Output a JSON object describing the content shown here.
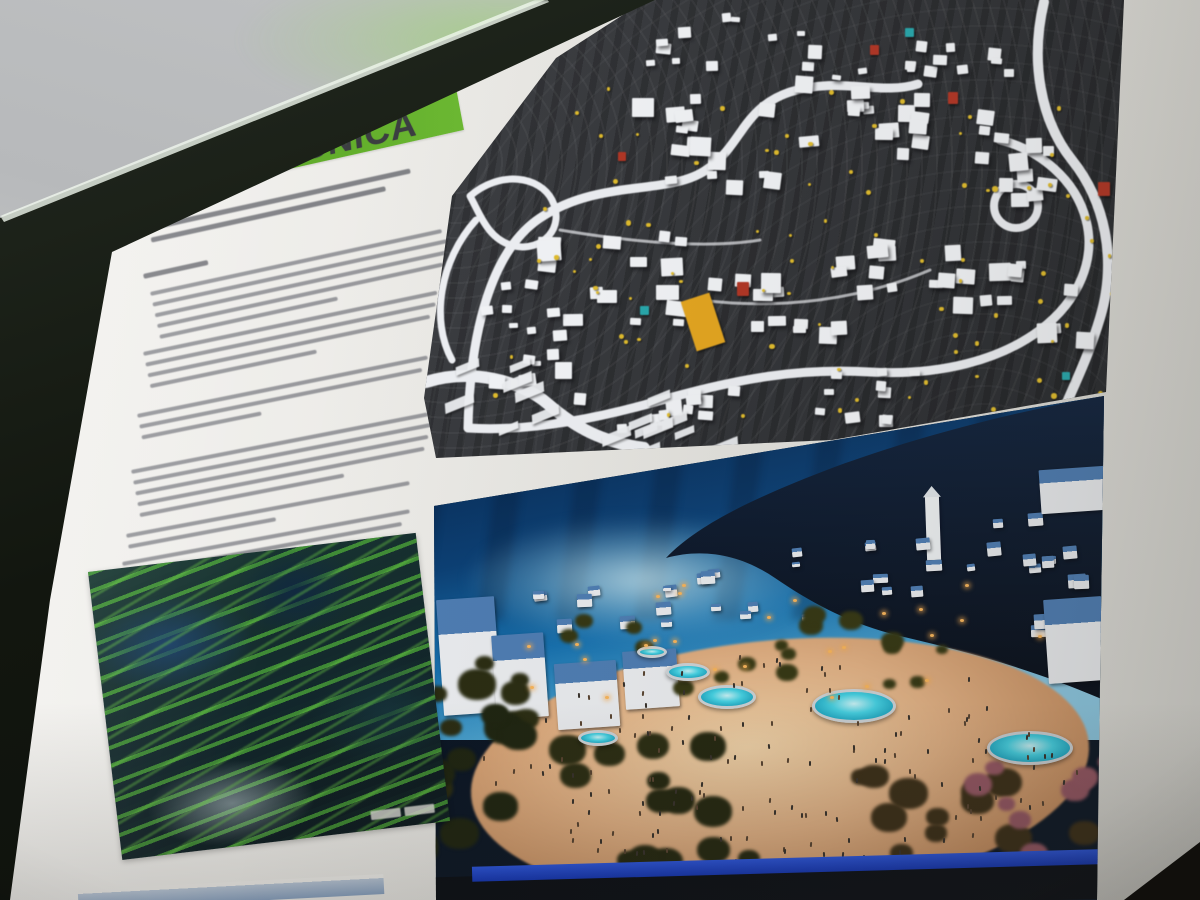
{
  "logo": {
    "kicker": "NOVA",
    "title": "KOREŠNICA",
    "banner_color": "#5fa827",
    "title_color": "#3b3e41"
  },
  "text_column": {
    "quote_lines": [
      268,
      240
    ],
    "attribution_width": 66,
    "paragraphs": [
      [
        298,
        306,
        300,
        292,
        182
      ],
      [
        300,
        296,
        288,
        170
      ],
      [
        296,
        288,
        122
      ],
      [
        302,
        306,
        298,
        292,
        208
      ],
      [
        288,
        150
      ],
      [
        292,
        282,
        96
      ],
      [
        268,
        112
      ]
    ]
  },
  "images": {
    "site_model": {
      "terrain": "#35373b",
      "buildings": "#f3f5f8",
      "roads": "#eef0f4",
      "marker_yellow": "#e2bd2c",
      "marker_red": "#b23524",
      "marker_teal": "#27a8ad",
      "marker_orange": "#e5a61f"
    },
    "vision_render": {
      "sky_top": "#061f42",
      "sky_horizon": "#8cc8e2",
      "mountain": "#0c1526",
      "plaza": "#e2b184",
      "pool": "#44d2e4",
      "roof_blue": "#4d7cb2",
      "house_white": "#e9ebee",
      "foliage_dark": "#2a2c12",
      "foliage_pink": "#965663",
      "water_strip": "#1d43d2"
    },
    "terrain_art": {
      "base_dark": "#12262b",
      "vegetation_green": "#56be3a",
      "shadow_blue": "#1c426e"
    }
  },
  "environment": {
    "wall": "#c3c5c6",
    "frame": "#161a12",
    "backdrop": "#141713",
    "glow_green": "#96d764",
    "poster_white": "#eceae6"
  }
}
